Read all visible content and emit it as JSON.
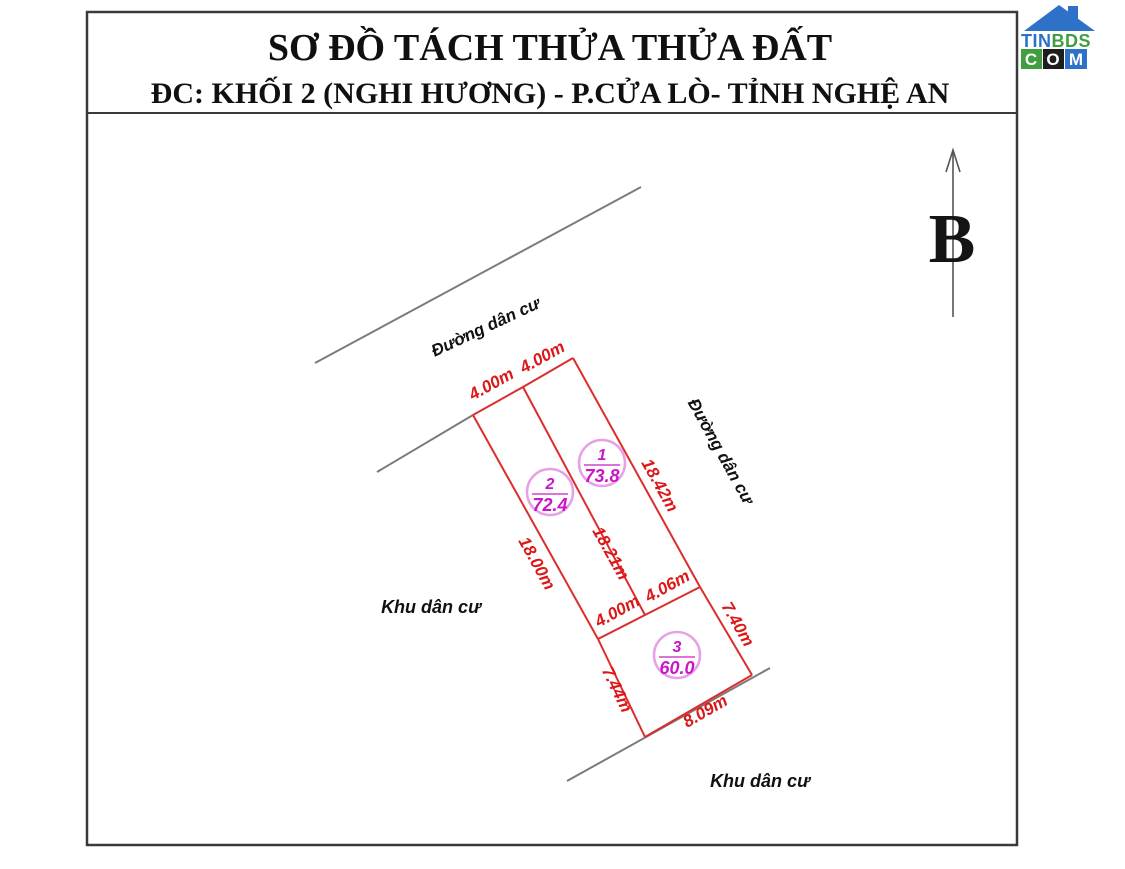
{
  "title": {
    "line1": "SƠ ĐỒ TÁCH THỬA THỬA ĐẤT",
    "line2": "ĐC: KHỐI 2 (NGHI HƯƠNG) - P.CỬA LÒ- TỈNH NGHỆ AN"
  },
  "logo": {
    "tin": "TIN",
    "bds": "BDS",
    "c": "C",
    "o": "O",
    "m": "M"
  },
  "compass": {
    "north_label": "B"
  },
  "road_labels": [
    {
      "position": "top",
      "label": "Đường dân cư"
    },
    {
      "position": "right",
      "label": "Đường dân cư"
    }
  ],
  "area_labels": [
    {
      "position": "left",
      "label": "Khu dân cư"
    },
    {
      "position": "bottom",
      "label": "Khu dân cư"
    }
  ],
  "plots": [
    {
      "number": "1",
      "area": "73.8"
    },
    {
      "number": "2",
      "area": "72.4"
    },
    {
      "number": "3",
      "area": "60.0"
    }
  ],
  "dims": [
    {
      "edge": "plot2-top",
      "label": "4.00m"
    },
    {
      "edge": "plot1-top",
      "label": "4.00m"
    },
    {
      "edge": "plot1-right",
      "label": "18.42m"
    },
    {
      "edge": "plot1-left-divider",
      "label": "18.21m"
    },
    {
      "edge": "plot2-left",
      "label": "18.00m"
    },
    {
      "edge": "plot2-bottom",
      "label": "4.00m"
    },
    {
      "edge": "plot1-bottom",
      "label": "4.06m"
    },
    {
      "edge": "plot3-left",
      "label": "7.44m"
    },
    {
      "edge": "plot3-right",
      "label": "7.40m"
    },
    {
      "edge": "plot3-bottom",
      "label": "8.09m"
    }
  ],
  "colors": {
    "plot_line": "#dd2c2c",
    "dim_text": "#dd1717",
    "plot_label": "#c816c8",
    "road_line": "#7b7b7b",
    "logo_blue": "#2d72c8",
    "logo_green": "#3f9e3f"
  }
}
